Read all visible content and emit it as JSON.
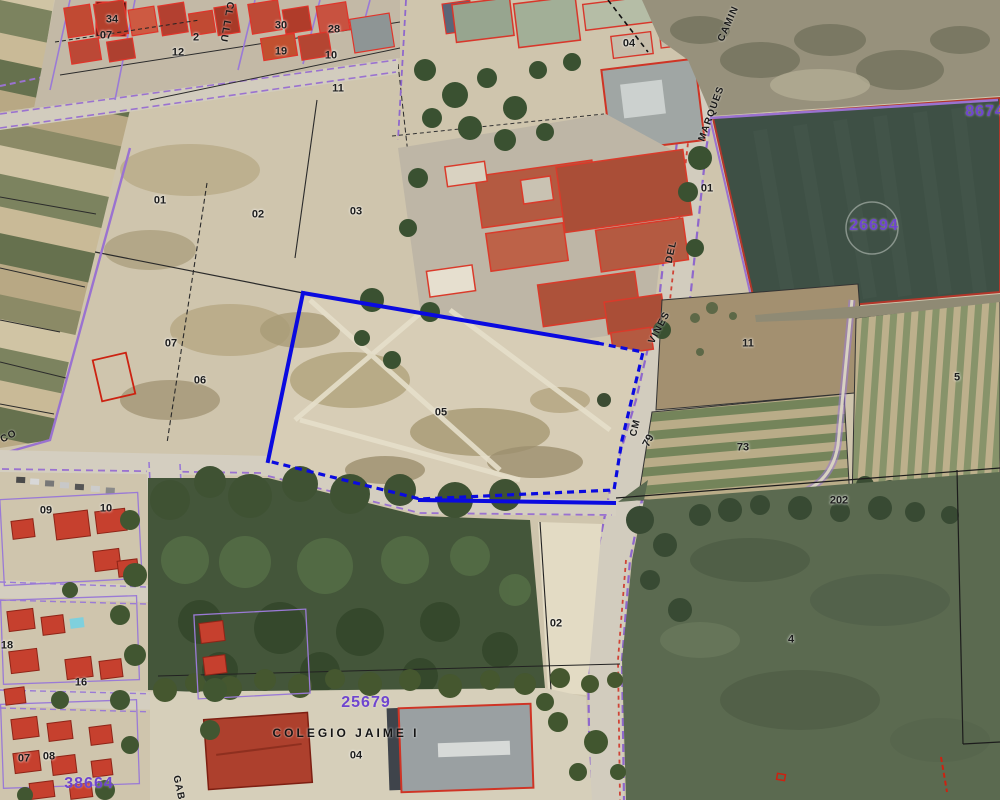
{
  "title": "Aerial cadastral map view",
  "map": {
    "colors": {
      "ref_purple": "#6f45cf",
      "cadastral_purple": "#8f68cc",
      "selection_blue": "#0a0ae0",
      "building_red": "#cf3425",
      "parcel_line_black": "#222222"
    },
    "selected_parcel": {
      "label": "05",
      "boundary_color": "#0a0ae0"
    },
    "cadastral_references": [
      "26694",
      "25679",
      "38664",
      "8674"
    ],
    "labels": [
      {
        "text": "34",
        "x": 112,
        "y": 20,
        "cls": "parcel"
      },
      {
        "text": "07",
        "x": 106,
        "y": 36,
        "cls": "parcel"
      },
      {
        "text": "2",
        "x": 196,
        "y": 38,
        "cls": "parcel"
      },
      {
        "text": "12",
        "x": 178,
        "y": 53,
        "cls": "parcel"
      },
      {
        "text": "30",
        "x": 281,
        "y": 26,
        "cls": "parcel"
      },
      {
        "text": "19",
        "x": 281,
        "y": 52,
        "cls": "parcel"
      },
      {
        "text": "28",
        "x": 334,
        "y": 30,
        "cls": "parcel"
      },
      {
        "text": "10",
        "x": 331,
        "y": 56,
        "cls": "parcel"
      },
      {
        "text": "11",
        "x": 338,
        "y": 89,
        "cls": "parcel"
      },
      {
        "text": "04",
        "x": 629,
        "y": 44,
        "cls": "parcel"
      },
      {
        "text": "01",
        "x": 707,
        "y": 189,
        "cls": "parcel"
      },
      {
        "text": "01",
        "x": 160,
        "y": 201,
        "cls": "parcel"
      },
      {
        "text": "02",
        "x": 258,
        "y": 215,
        "cls": "parcel"
      },
      {
        "text": "03",
        "x": 356,
        "y": 212,
        "cls": "parcel"
      },
      {
        "text": "07",
        "x": 171,
        "y": 344,
        "cls": "parcel"
      },
      {
        "text": "06",
        "x": 200,
        "y": 381,
        "cls": "parcel"
      },
      {
        "text": "05",
        "x": 441,
        "y": 413,
        "cls": "parcel"
      },
      {
        "text": "11",
        "x": 748,
        "y": 344,
        "cls": "parcel"
      },
      {
        "text": "79",
        "x": 649,
        "y": 441,
        "cls": "parcel",
        "rot": -62
      },
      {
        "text": "73",
        "x": 743,
        "y": 448,
        "cls": "parcel"
      },
      {
        "text": "202",
        "x": 839,
        "y": 501,
        "cls": "parcel"
      },
      {
        "text": "5",
        "x": 957,
        "y": 378,
        "cls": "parcel"
      },
      {
        "text": "02",
        "x": 556,
        "y": 624,
        "cls": "parcel"
      },
      {
        "text": "04",
        "x": 356,
        "y": 756,
        "cls": "parcel"
      },
      {
        "text": "4",
        "x": 791,
        "y": 640,
        "cls": "parcel"
      },
      {
        "text": "09",
        "x": 46,
        "y": 511,
        "cls": "parcel"
      },
      {
        "text": "10",
        "x": 106,
        "y": 509,
        "cls": "parcel"
      },
      {
        "text": "18",
        "x": 7,
        "y": 646,
        "cls": "parcel"
      },
      {
        "text": "16",
        "x": 81,
        "y": 683,
        "cls": "parcel"
      },
      {
        "text": "07",
        "x": 24,
        "y": 759,
        "cls": "parcel"
      },
      {
        "text": "08",
        "x": 49,
        "y": 757,
        "cls": "parcel"
      },
      {
        "text": "CAMIN",
        "x": 729,
        "y": 24,
        "cls": "street",
        "rot": -66
      },
      {
        "text": "MARQUES",
        "x": 712,
        "y": 114,
        "cls": "street",
        "rot": -70
      },
      {
        "text": "DEL",
        "x": 672,
        "y": 252,
        "cls": "street",
        "rot": -78
      },
      {
        "text": "VINES",
        "x": 660,
        "y": 328,
        "cls": "street",
        "rot": -62
      },
      {
        "text": "CM",
        "x": 636,
        "y": 428,
        "cls": "street",
        "rot": -76
      },
      {
        "text": "CL LLU",
        "x": 226,
        "y": 22,
        "cls": "street",
        "rot": 100
      },
      {
        "text": "GAB",
        "x": 178,
        "y": 788,
        "cls": "street",
        "rot": 78
      },
      {
        "text": "CO",
        "x": 9,
        "y": 437,
        "cls": "street",
        "rot": -28
      },
      {
        "text": "26694",
        "x": 874,
        "y": 226,
        "cls": "ref"
      },
      {
        "text": "25679",
        "x": 366,
        "y": 703,
        "cls": "ref"
      },
      {
        "text": "38664",
        "x": 89,
        "y": 784,
        "cls": "ref"
      },
      {
        "text": "8674",
        "x": 985,
        "y": 112,
        "cls": "ref"
      },
      {
        "text": "COLEGIO JAIME I",
        "x": 346,
        "y": 733,
        "cls": "poi"
      }
    ]
  }
}
